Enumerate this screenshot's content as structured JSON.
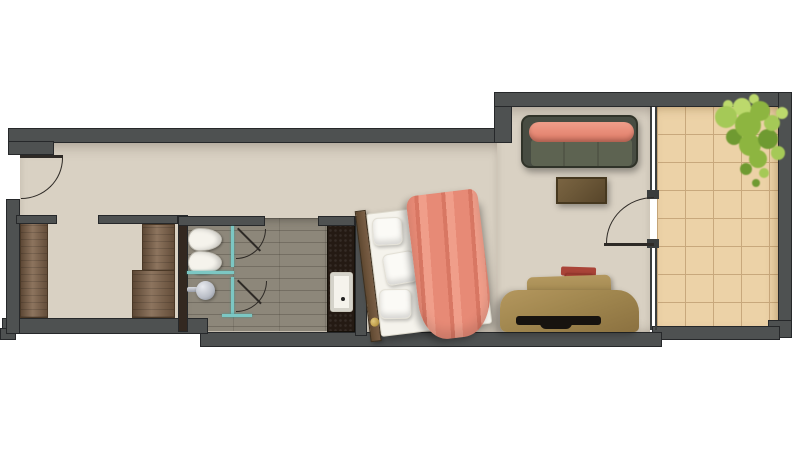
{
  "meta": {
    "type": "floor-plan",
    "description": "Top-down 3D-rendered floor plan of a long studio hotel room: entry hall, wardrobe alcove, bathroom with two WCs, shower and vanity, bedroom-living area with double bed, sofa, coffee table and desk, glazed wall with door onto a tiled balcony with a plant",
    "width_px": 800,
    "height_px": 450
  },
  "palette": {
    "wall": "#4e5151",
    "wallLine": "#26282a",
    "darkPanel": "#332820",
    "floor": "#d9d1c3",
    "bathTile": "#8d877a",
    "balcTile": "#ecd2a7",
    "balcLine": "#c8a87c",
    "wood": "#7d6148",
    "woodLine": "#4a3826",
    "vanity": "#241a13",
    "fixture": "#f5f3ec",
    "teal": "#7cc7c3",
    "frame": "#3a3d3d",
    "arc": "#2e2a26",
    "sofaFrame": "#474c42",
    "sofaSeat": "#5d6351",
    "coral": "#e78a76",
    "coralLight": "#f09e8a",
    "coralDark": "#d87763",
    "table": "#6d5939",
    "desk": "#a1874f",
    "deskDark": "#8b7140",
    "chair": "#c95d4b",
    "chairDark": "#aa4438",
    "slot": "#17130f",
    "gold": "#c4a24d",
    "shower": "#b9bdc6",
    "plant1": "#8db540",
    "plant2": "#a5c957",
    "plant3": "#6f9a31",
    "plant4": "#bcd96c"
  },
  "rooms": {
    "entry": "Entry hall",
    "alcove": "Wardrobe alcove",
    "bathroom": "Bathroom",
    "bedroom": "Bedroom / living area",
    "balcony": "Balcony"
  },
  "items": {
    "entry_door": "Entry door (swing inward)",
    "wardrobe_left": "Wardrobe (left)",
    "wardrobe_right": "Wardrobe (right, L-shaped)",
    "toilet_1": "Toilet",
    "toilet_2": "Bidet / second toilet",
    "shower": "Shower head",
    "glass_partition": "Glass shower partition",
    "stall_door_1": "Toilet stall door",
    "stall_door_2": "Shower stall door",
    "vanity": "Vanity counter",
    "sink": "Sink basin",
    "bed": "Double bed with coral blanket and pillows",
    "headboard": "Wooden headboard",
    "sofa": "Sofa with coral bolster cushion",
    "coffee_table": "Coffee table",
    "desk": "Desk",
    "desk_chair": "Desk chair",
    "balcony_door": "Balcony door (swing inward)",
    "glazed_wall": "Glazed wall to balcony",
    "plant": "Potted plant",
    "balcony_floor": "Tiled balcony floor"
  }
}
